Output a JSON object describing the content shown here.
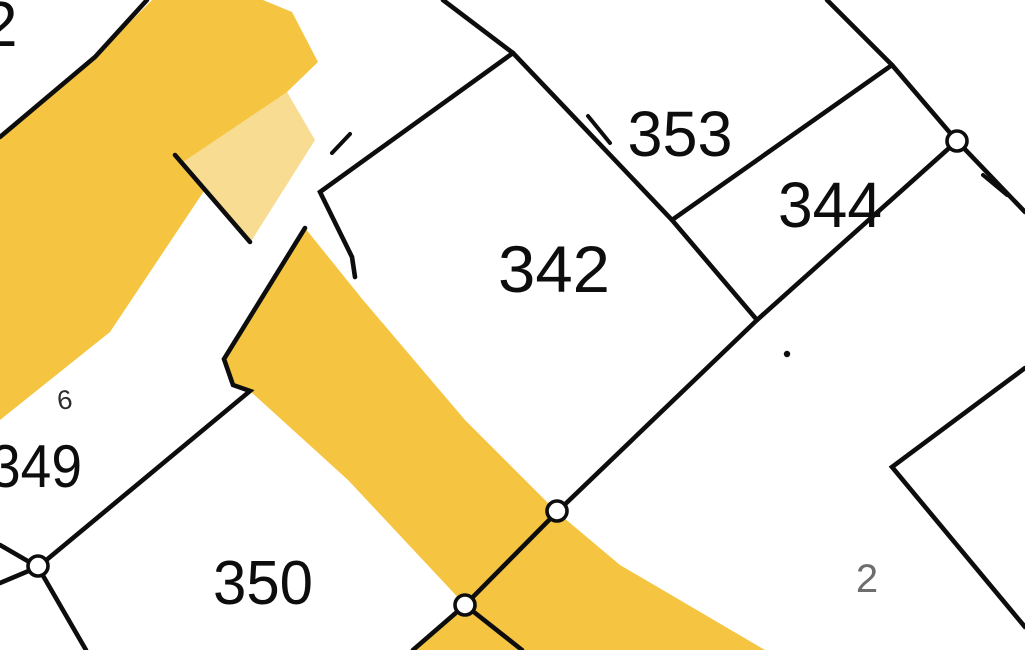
{
  "map": {
    "background": "#ffffff",
    "colors": {
      "road": "#F5C542",
      "road_light": "#F8DC92",
      "line": "#0d0d0d",
      "label": "#0d0d0d"
    },
    "roads": [
      {
        "name": "road-band-upper-left",
        "fill": "road",
        "points": [
          [
            152,
            0
          ],
          [
            263,
            0
          ],
          [
            292,
            12
          ],
          [
            318,
            62
          ],
          [
            287,
            92
          ],
          [
            230,
            152
          ],
          [
            110,
            332
          ],
          [
            0,
            420
          ],
          [
            0,
            135
          ],
          [
            95,
            57
          ]
        ]
      },
      {
        "name": "road-band-pale-strip",
        "fill": "road_light",
        "points": [
          [
            287,
            92
          ],
          [
            315,
            140
          ],
          [
            250,
            243
          ],
          [
            183,
            162
          ]
        ]
      },
      {
        "name": "road-band-center",
        "fill": "road",
        "points": [
          [
            305,
            228
          ],
          [
            363,
            300
          ],
          [
            465,
            420
          ],
          [
            557,
            512
          ],
          [
            465,
            605
          ],
          [
            348,
            480
          ],
          [
            250,
            391
          ],
          [
            233,
            385
          ],
          [
            224,
            359
          ]
        ]
      },
      {
        "name": "road-band-lower-right",
        "fill": "road",
        "points": [
          [
            557,
            512
          ],
          [
            620,
            565
          ],
          [
            765,
            650
          ],
          [
            415,
            650
          ],
          [
            465,
            605
          ]
        ]
      }
    ],
    "boundaries": [
      {
        "name": "boundary-line-top-left",
        "points": [
          [
            147,
            0
          ],
          [
            95,
            57
          ],
          [
            0,
            137
          ]
        ]
      },
      {
        "name": "boundary-line-cross-road",
        "points": [
          [
            175,
            155
          ],
          [
            250,
            242
          ]
        ]
      },
      {
        "name": "boundary-line-parcel342-north-notch",
        "points": [
          [
            513,
            53
          ],
          [
            320,
            192
          ],
          [
            352,
            257
          ],
          [
            355,
            277
          ]
        ]
      },
      {
        "name": "boundary-line-top-center",
        "points": [
          [
            443,
            0
          ],
          [
            513,
            53
          ]
        ]
      },
      {
        "name": "boundary-line-342-353",
        "points": [
          [
            513,
            53
          ],
          [
            672,
            220
          ],
          [
            757,
            320
          ]
        ]
      },
      {
        "name": "boundary-line-top-right",
        "points": [
          [
            827,
            0
          ],
          [
            892,
            65
          ],
          [
            957,
            141
          ],
          [
            1025,
            212
          ]
        ]
      },
      {
        "name": "boundary-line-353-344",
        "points": [
          [
            892,
            65
          ],
          [
            672,
            220
          ]
        ]
      },
      {
        "name": "boundary-line-main-diagonal",
        "points": [
          [
            957,
            141
          ],
          [
            757,
            320
          ],
          [
            557,
            512
          ],
          [
            465,
            605
          ],
          [
            413,
            650
          ]
        ]
      },
      {
        "name": "boundary-line-road-spur",
        "points": [
          [
            465,
            605
          ],
          [
            522,
            650
          ]
        ]
      },
      {
        "name": "boundary-line-349-350",
        "points": [
          [
            305,
            228
          ],
          [
            224,
            359
          ],
          [
            233,
            385
          ],
          [
            250,
            391
          ],
          [
            38,
            567
          ]
        ]
      },
      {
        "name": "boundary-line-sw-south",
        "points": [
          [
            38,
            567
          ],
          [
            86,
            650
          ]
        ]
      },
      {
        "name": "boundary-line-sw-west-upper",
        "points": [
          [
            38,
            567
          ],
          [
            0,
            545
          ]
        ]
      },
      {
        "name": "boundary-line-sw-west-lower",
        "points": [
          [
            38,
            567
          ],
          [
            0,
            583
          ]
        ]
      },
      {
        "name": "boundary-line-bottom-right-corner",
        "points": [
          [
            1025,
            368
          ],
          [
            892,
            467
          ],
          [
            1025,
            627
          ]
        ]
      }
    ],
    "ticks": [
      {
        "name": "boundary-tick-353",
        "points": [
          [
            588,
            116
          ],
          [
            610,
            143
          ]
        ]
      },
      {
        "name": "boundary-tick-north-east",
        "points": [
          [
            983,
            175
          ],
          [
            1007,
            195
          ]
        ]
      },
      {
        "name": "boundary-tick-notch",
        "points": [
          [
            332,
            153
          ],
          [
            350,
            134
          ]
        ]
      }
    ],
    "markers": [
      {
        "name": "boundary-point-north-east",
        "cx": 957,
        "cy": 141
      },
      {
        "name": "boundary-point-center",
        "cx": 557,
        "cy": 511
      },
      {
        "name": "boundary-point-lower",
        "cx": 465,
        "cy": 605
      },
      {
        "name": "boundary-point-south-west",
        "cx": 38,
        "cy": 566
      }
    ],
    "dot": {
      "name": "point-marker-344-south",
      "cx": 787,
      "cy": 354,
      "r": 3.2
    },
    "parcel_labels": [
      {
        "name": "parcel-label-top-left-2",
        "text": "2",
        "x": -18,
        "y": 46,
        "size": 64,
        "anchor": "start"
      },
      {
        "name": "parcel-label-353",
        "text": "353",
        "x": 680,
        "y": 156,
        "size": 64,
        "anchor": "middle",
        "length": 105
      },
      {
        "name": "parcel-label-344",
        "text": "344",
        "x": 830,
        "y": 227,
        "size": 64,
        "anchor": "middle",
        "length": 104
      },
      {
        "name": "parcel-label-342",
        "text": "342",
        "x": 554,
        "y": 292,
        "size": 66,
        "anchor": "middle",
        "length": 112
      },
      {
        "name": "parcel-label-349",
        "text": "349",
        "x": -10,
        "y": 487,
        "size": 60,
        "anchor": "start",
        "length": 92
      },
      {
        "name": "parcel-label-350",
        "text": "350",
        "x": 263,
        "y": 604,
        "size": 62,
        "anchor": "middle",
        "length": 100
      },
      {
        "name": "parcel-label-6",
        "text": "6",
        "x": 66,
        "y": 409,
        "size": 27,
        "anchor": "middle",
        "color": "#2e2e2e",
        "rotate": -8
      },
      {
        "name": "parcel-label-small-2",
        "text": "2",
        "x": 867,
        "y": 592,
        "size": 40,
        "anchor": "middle",
        "color": "#6e6e6e"
      }
    ]
  }
}
